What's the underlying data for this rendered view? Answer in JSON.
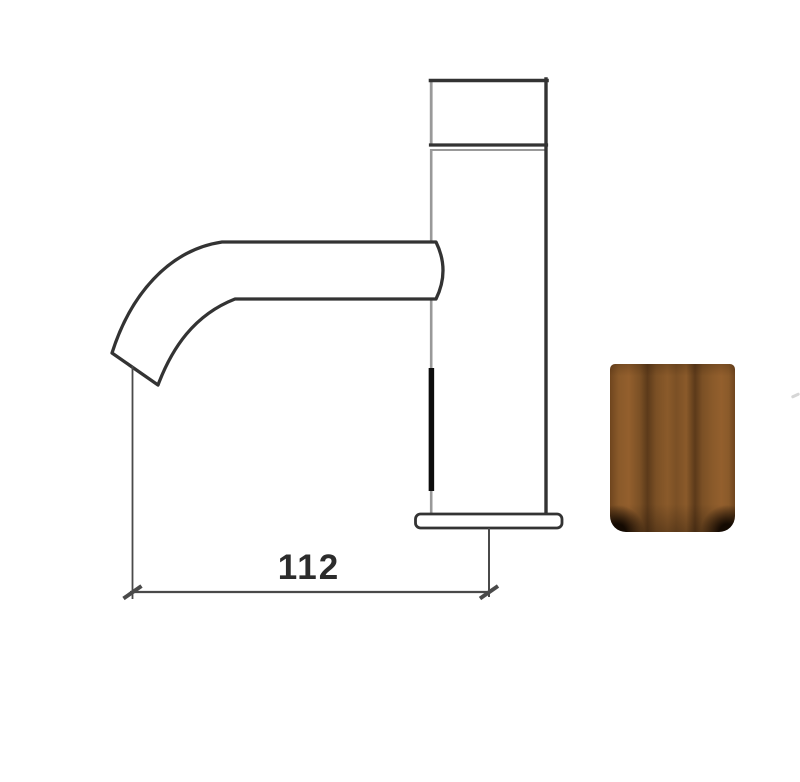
{
  "page": {
    "background": "#ffffff"
  },
  "drawing": {
    "subject": "sensor-faucet-side-elevation",
    "dimension": {
      "value": "112"
    },
    "colors": {
      "line_dark": "#333333",
      "line_grey": "#999999",
      "sensor_strip": "#0d0d0d",
      "dimension_line": "#4a4a4a",
      "text": "#2c2c2c"
    }
  },
  "swatch": {
    "name": "bronze-finish-sample"
  },
  "colors": {
    "canvas-bg": "#ffffff",
    "swatch-base": "#8a5a2a",
    "swatch-light": "#935f2d",
    "swatch-mid": "#7b5025",
    "swatch-dark": "#5c3a1a",
    "swatch-edge": "#6f451e",
    "swatch-vignette": "#140a02"
  }
}
